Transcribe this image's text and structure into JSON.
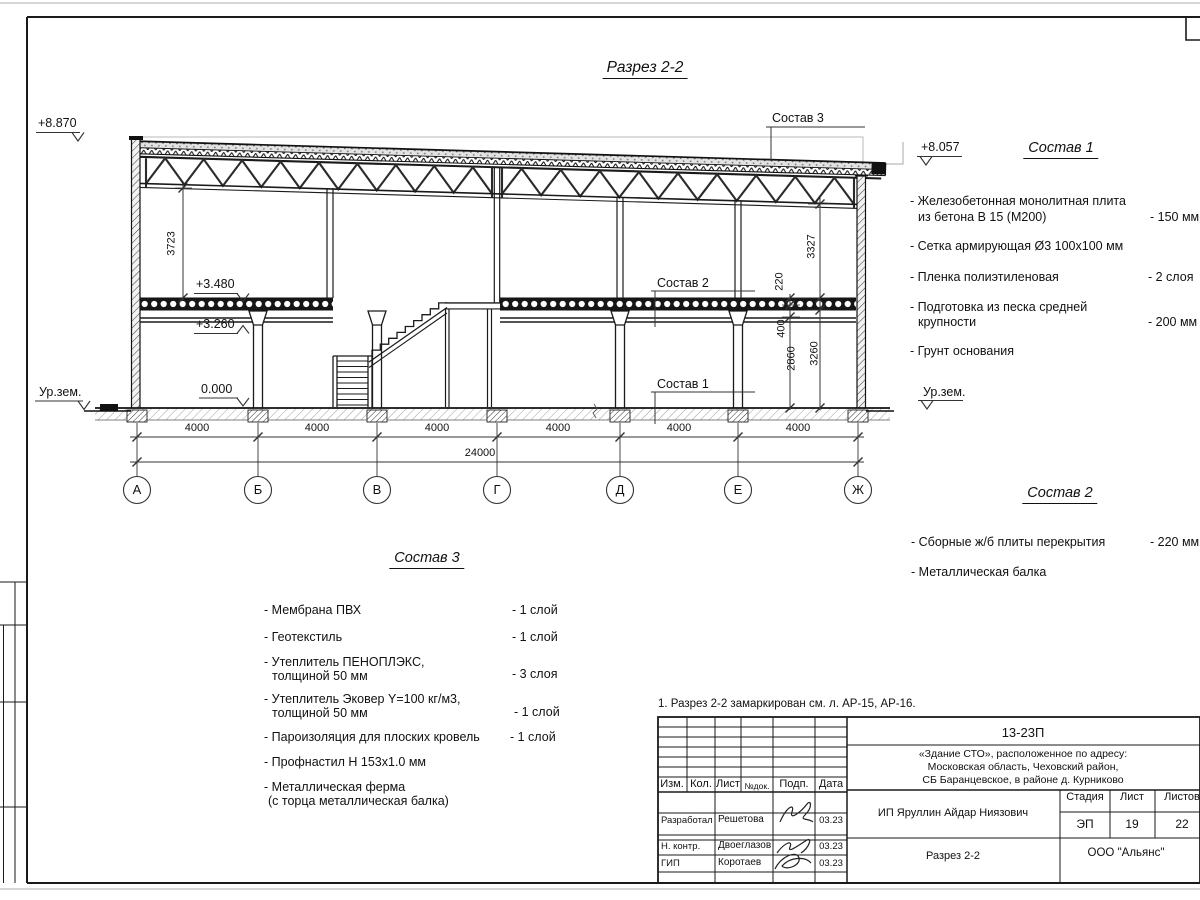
{
  "page": {
    "title": "Разрез 2-2",
    "note": "1. Разрез 2-2 замаркирован см. л. АР-15, АР-16."
  },
  "levels": {
    "roof_left": "+8.870",
    "roof_right": "+8.057",
    "slab_top": "+3.480",
    "beam_bottom": "+3.260",
    "zero": "0.000",
    "ground_left": "Ур.зем.",
    "ground_right": "Ур.зем."
  },
  "dims": {
    "bays": [
      "4000",
      "4000",
      "4000",
      "4000",
      "4000",
      "4000"
    ],
    "total": "24000",
    "truss_clear": "3723",
    "right_upper": "3327",
    "slab_thk": "220",
    "beam_h": "400",
    "clear_h": "2860",
    "floor_h": "3260"
  },
  "axes": [
    "А",
    "Б",
    "В",
    "Г",
    "Д",
    "Е",
    "Ж"
  ],
  "leaders": {
    "s1": "Состав 1",
    "s2": "Состав 2",
    "s3": "Состав 3"
  },
  "sostav1": {
    "heading": "Состав 1",
    "items": [
      {
        "l1": "- Железобетонная  монолитная плита",
        "l2": "из бетона В 15 (М200)",
        "value": "- 150 мм"
      },
      {
        "l1": "- Сетка армирующая Ø3 100х100 мм",
        "l2": "",
        "value": ""
      },
      {
        "l1": "- Пленка полиэтиленовая",
        "l2": "",
        "value": "-  2 слоя"
      },
      {
        "l1": "- Подготовка из песка средней",
        "l2": "крупности",
        "value": "- 200 мм"
      },
      {
        "l1": "- Грунт основания",
        "l2": "",
        "value": ""
      }
    ]
  },
  "sostav2": {
    "heading": "Состав 2",
    "items": [
      {
        "l1": "- Сборные ж/б плиты перекрытия",
        "value": "- 220 мм"
      },
      {
        "l1": "- Металлическая  балка",
        "value": ""
      }
    ]
  },
  "sostav3": {
    "heading": "Состав 3",
    "items": [
      {
        "l1": "- Мембрана ПВХ",
        "l2": "",
        "value": "- 1 слой"
      },
      {
        "l1": "- Геотекстиль",
        "l2": "",
        "value": "- 1 слой"
      },
      {
        "l1": "- Утеплитель ПЕНОПЛЭКС,",
        "l2": "толщиной 50 мм",
        "value": "- 3 слоя"
      },
      {
        "l1": "- Утеплитель Эковер Y=100 кг/м3,",
        "l2": "толщиной 50 мм",
        "value": "- 1 слой"
      },
      {
        "l1": "- Пароизоляция для плоских кровель",
        "l2": "",
        "value": "- 1 слой"
      },
      {
        "l1": "- Профнастил Н 153х1.0 мм",
        "l2": "",
        "value": ""
      },
      {
        "l1": "- Металлическая ферма",
        "l2": "(с торца металлическая балка)",
        "value": ""
      }
    ]
  },
  "titleblock": {
    "doc_number": "13-23П",
    "object_line1": "«Здание СТО», расположенное по адресу:",
    "object_line2": "Московская область, Чеховский район,",
    "object_line3": "СБ Баранцевское, в районе д. Курниково",
    "cols": {
      "izm": "Изм.",
      "kol": "Кол.",
      "list": "Лист",
      "ndok": "№док.",
      "podp": "Подп.",
      "data": "Дата"
    },
    "rows": [
      {
        "role": "Разработал",
        "name": "Решетова",
        "date": "03.23"
      },
      {
        "role": "Н. контр.",
        "name": "Двоеглазов",
        "date": "03.23"
      },
      {
        "role": "ГИП",
        "name": "Коротаев",
        "date": "03.23"
      }
    ],
    "client": "ИП Яруллин Айдар Ниязович",
    "stage_label": "Стадия",
    "sheet_label": "Лист",
    "sheets_label": "Листов",
    "stage": "ЭП",
    "sheet": "19",
    "sheets": "22",
    "drawing_name": "Разрез 2-2",
    "company": "ООО \"Альянс\""
  }
}
